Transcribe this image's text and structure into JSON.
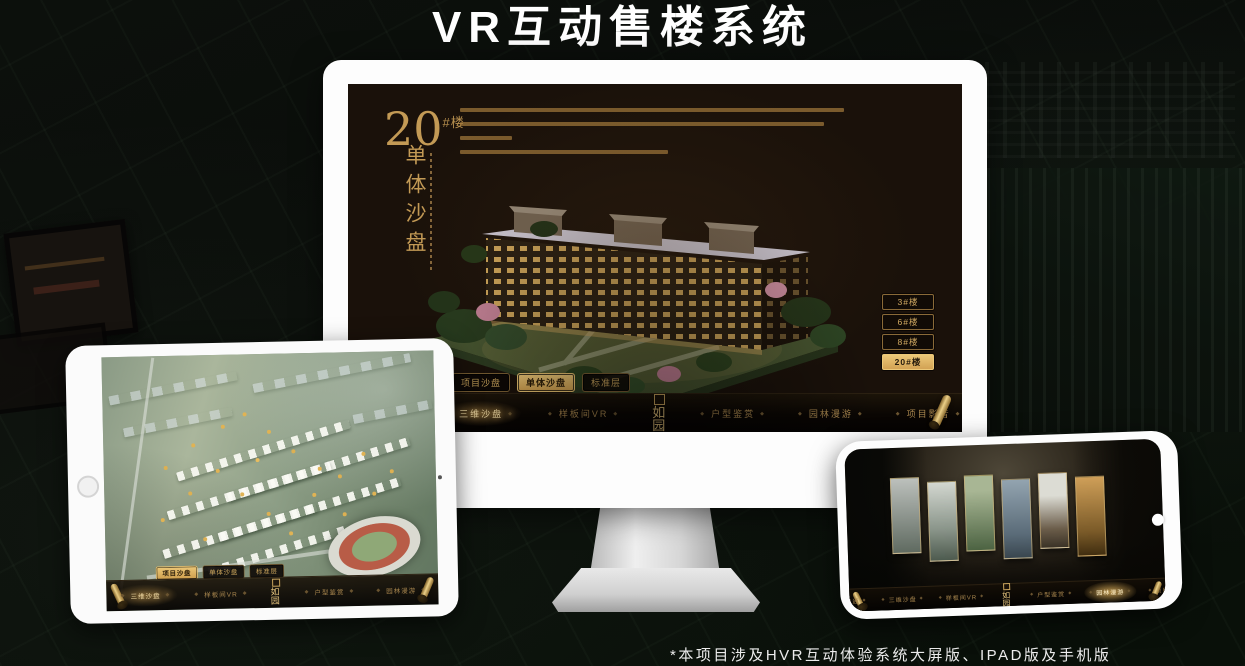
{
  "page": {
    "title": "VR互动售楼系统",
    "footnote": "*本项目涉及HVR互动体验系统大屏版、IPAD版及手机版"
  },
  "colors": {
    "gold": "#c9a15f",
    "gold_bright": "#ecc878",
    "screen_bg": "#1a110a",
    "active_tab_bg": "#d8ae62"
  },
  "monitor": {
    "headline": {
      "number": "20",
      "suffix": "#楼",
      "subtitle_vertical": "单体沙盘"
    },
    "floor_buttons": [
      {
        "label": "3#楼",
        "active": false
      },
      {
        "label": "6#楼",
        "active": false
      },
      {
        "label": "8#楼",
        "active": false
      },
      {
        "label": "20#楼",
        "active": true
      }
    ],
    "tabs": [
      {
        "label": "项目沙盘",
        "active": false
      },
      {
        "label": "单体沙盘",
        "active": true
      },
      {
        "label": "标准层",
        "active": false
      }
    ],
    "nav": {
      "left": [
        "区位交通",
        "三维沙盘",
        "样板间VR"
      ],
      "right": [
        "户型鉴赏",
        "园林漫游",
        "项目影音"
      ],
      "active": "三维沙盘",
      "logo": "如园"
    }
  },
  "tablet": {
    "tabs": [
      {
        "label": "项目沙盘",
        "active": true
      },
      {
        "label": "单体沙盘",
        "active": false
      },
      {
        "label": "标准层",
        "active": false
      }
    ],
    "nav": {
      "left": [
        "区位交通",
        "三维沙盘",
        "样板间VR"
      ],
      "right": [
        "户型鉴赏",
        "园林漫游",
        "项目影音"
      ],
      "active": "三维沙盘",
      "logo": "如园"
    }
  },
  "phone": {
    "nav": {
      "left": [
        "区位交通",
        "三维沙盘",
        "样板间VR"
      ],
      "right": [
        "户型鉴赏",
        "园林漫游",
        "项目影音"
      ],
      "active": "园林漫游",
      "logo": "如园"
    }
  }
}
